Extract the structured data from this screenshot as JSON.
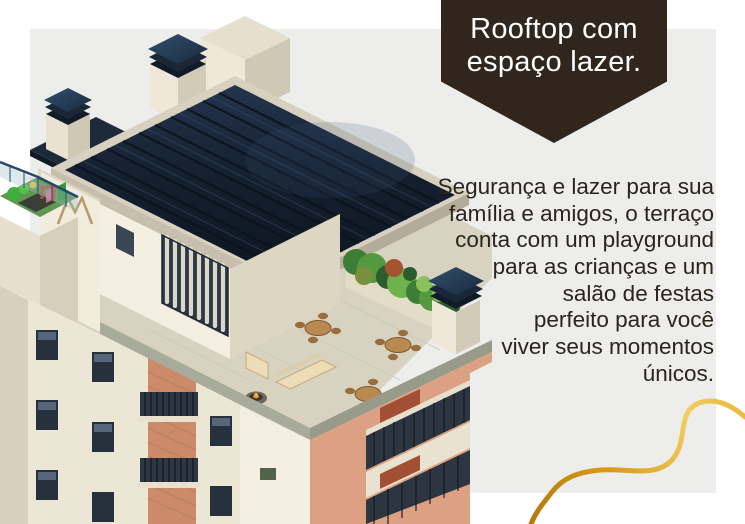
{
  "page": {
    "background": "#ffffff"
  },
  "panel": {
    "color": "#ededec"
  },
  "badge": {
    "background": "#30261d",
    "text_color": "#ffffff",
    "lines": [
      "Rooftop com",
      "espaço lazer."
    ]
  },
  "paragraph": {
    "color": "#2b241e",
    "lines": [
      "Segurança e lazer para sua",
      "família e amigos, o terraço",
      "conta com um playground",
      "para as crianças e um",
      "salão de festas",
      "perfeito para você",
      "viver seus momentos",
      "únicos."
    ]
  },
  "decor": {
    "gold_curve_colors": [
      "#a96f08",
      "#d89a18",
      "#f2cf63",
      "#e8b733"
    ]
  },
  "illustration": {
    "description_colors": {
      "roof_navy": "#16222f",
      "wall_cream": "#efe9d9",
      "salmon_accent": "#cb8a6a",
      "greenery": "#4e8a3a",
      "coping_gray": "#a8ab99"
    },
    "logo_mark": "M"
  }
}
